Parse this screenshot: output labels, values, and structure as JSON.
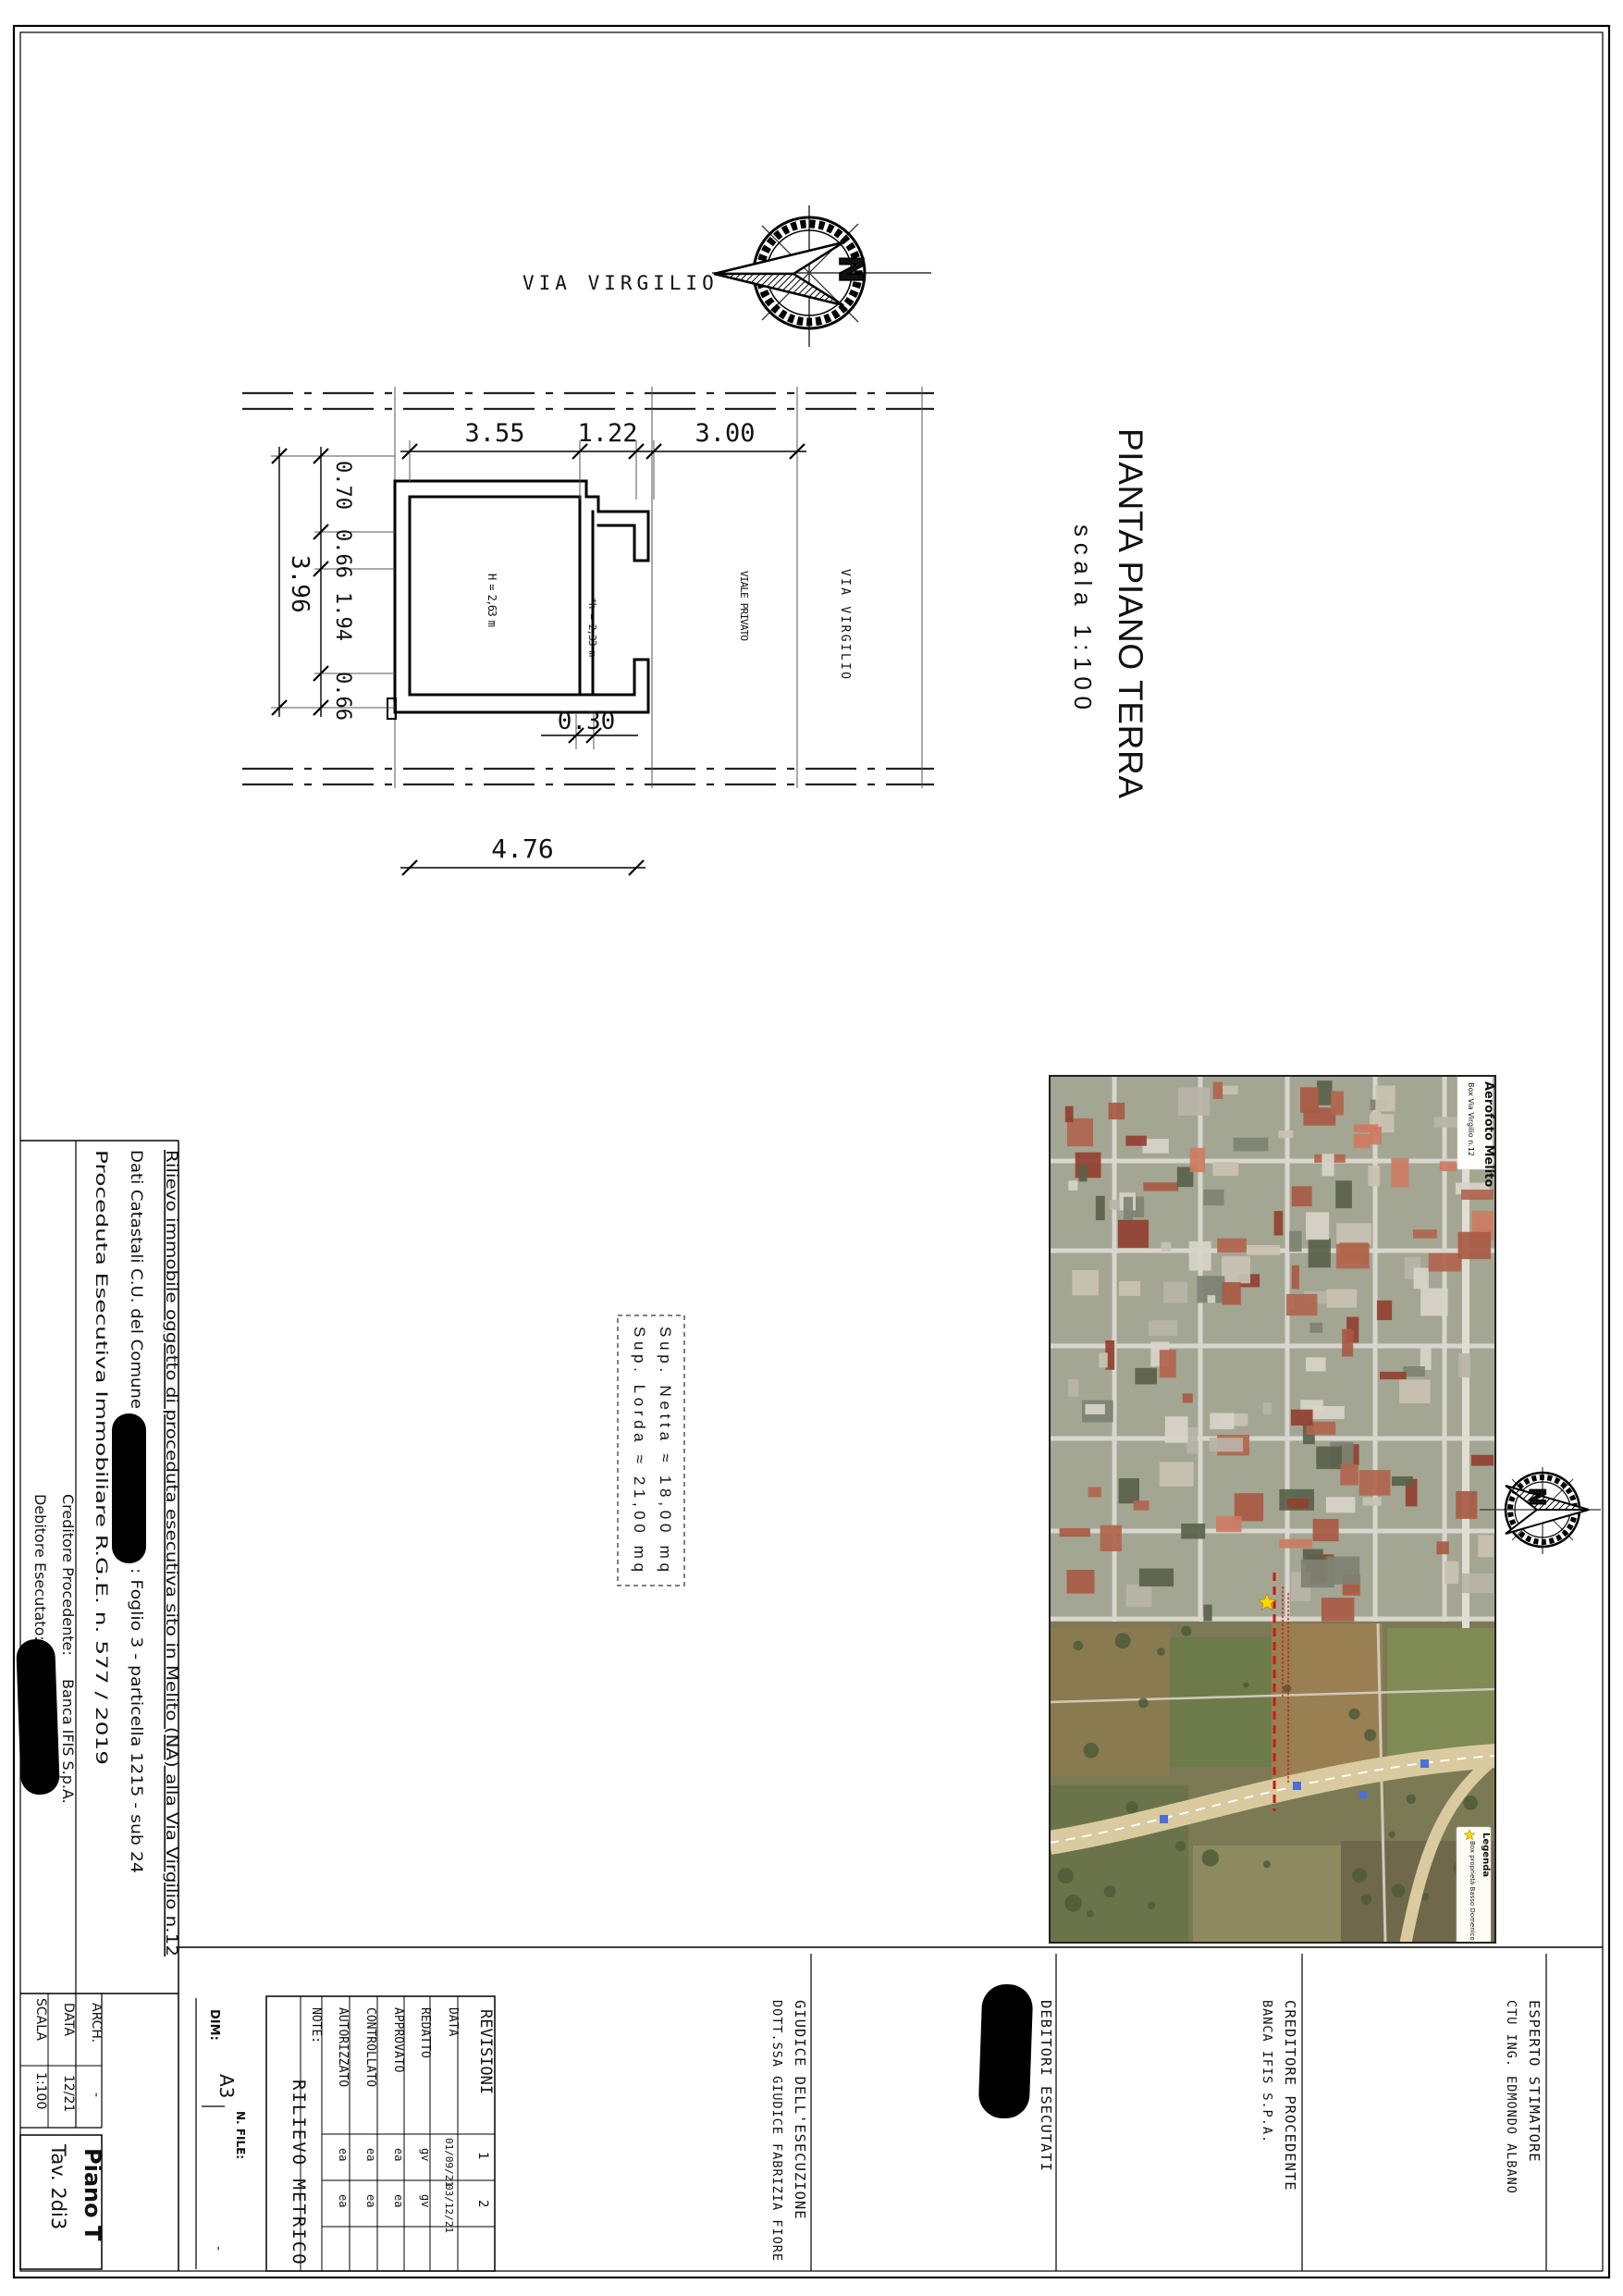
{
  "plan": {
    "street_top": "VIA VIRGILIO",
    "street_vertical": "VIA VIRGILIO",
    "lane_label": "VIALE PRIVATO",
    "title": "PIANTA PIANO TERRA",
    "scale": "scala 1:100",
    "north_letter": "N",
    "room_height": "H = 2,63 m",
    "opening_height": "*h = 2,33 m",
    "dims": {
      "top": [
        "3.55",
        "1.22",
        "3.00"
      ],
      "left_chain": [
        "0.70",
        "0.66",
        "1.94",
        "0.66"
      ],
      "left_total": "3.96",
      "partition": "0.30",
      "bottom_total": "4.76"
    }
  },
  "surface_box": {
    "netta": "Sup. Netta ≈  18,00 mq",
    "lorda": "Sup. Lorda ≈  21,00 mq"
  },
  "notes": {
    "line1": "Rilievo immobile oggetto di proceduta esecutiva sito  in Melito (NA) alla Via Virgilio n.12",
    "line2_pre": "Dati Catastali C.U. del Comune ",
    "line2_post": ": Foglio 3 - particella 1215 - sub 24",
    "line3": "Proceduta Esecutiva Immobiliare R.G.E. n. 577 / 2019",
    "creditore_label": "Creditore Procedente:",
    "creditore_value": "Banca IFIS S.p.A.",
    "debitore_label": "Debitore Esecutato:"
  },
  "map": {
    "card_title": "Aerofoto Melito",
    "card_subtitle": "Box Via Virgilio n.12",
    "legend_title": "Legenda",
    "legend_item": "Box proprietà Basso Domenico",
    "colors": {
      "field": "#8b926d",
      "urban": "#a3a693",
      "highway": "#d9cb9f",
      "annotation_red": "#cc1a0e",
      "star_yellow": "#ffd900",
      "marker_blue": "#4a6fd8"
    }
  },
  "titleblock": {
    "esperto1": "ESPERTO STIMATORE",
    "esperto2": "CTU ING. EDMONDO ALBANO",
    "creditore1": "CREDITORE PROCEDENTE",
    "creditore2": "BANCA IFIS S.P.A.",
    "debitori": "DEBITORI ESECUTATI",
    "giudice1": "GIUDICE DELL'ESECUZIONE",
    "giudice2": "DOTT.SSA GIUDICE FABRIZIA FIORE"
  },
  "revisions": {
    "title": "REVISIONI",
    "cols": [
      "1",
      "2"
    ],
    "rows": [
      {
        "label": "DATA",
        "values": [
          "01/09/21",
          "03/12/21"
        ]
      },
      {
        "label": "REDATTO",
        "values": [
          "gv",
          "gv"
        ]
      },
      {
        "label": "APPROVATO",
        "values": [
          "ea",
          "ea"
        ]
      },
      {
        "label": "CONTROLLATO",
        "values": [
          "ea",
          "ea"
        ]
      },
      {
        "label": "AUTORIZZATO",
        "values": [
          "ea",
          "ea"
        ]
      },
      {
        "label": "NOTE:",
        "values": [
          "",
          ""
        ]
      }
    ],
    "sheet_name": "RILIEVO METRICO",
    "dim_label": "DIM:",
    "dim_value": "A3",
    "file_label": "N. FILE:",
    "file_value": "-"
  },
  "info_table": {
    "arch_label": "ARCH.",
    "arch_value": "-",
    "data_label": "DATA",
    "data_value": "12/21",
    "scala_label": "SCALA",
    "scala_value": "1:100"
  },
  "tav": {
    "piano": "Piano T",
    "tavola": "Tav. 2di3"
  }
}
